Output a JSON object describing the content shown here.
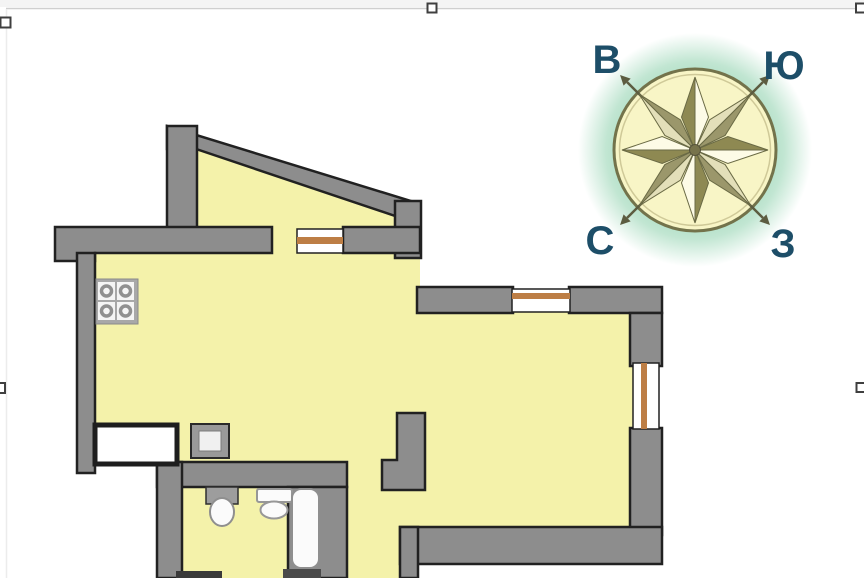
{
  "canvas": {
    "w": 864,
    "h": 578,
    "bg": "#ffffff"
  },
  "editor_selection": {
    "top_strip": {
      "x": 0,
      "y": 0,
      "w": 864,
      "h": 7,
      "fill": "#f4f4f4"
    },
    "lines": [
      {
        "name": "selection-border-top",
        "x1": 6,
        "y1": 8.5,
        "x2": 861,
        "y2": 8.5,
        "color": "#cfcfcf",
        "sw": 1.5
      },
      {
        "name": "selection-border-left",
        "x1": 6.5,
        "y1": 9,
        "x2": 6.5,
        "y2": 578,
        "color": "#ececec",
        "sw": 1.5
      }
    ],
    "handle_style": {
      "fill": "#ffffff",
      "stroke": "#3f3f3f",
      "sw": 2
    },
    "handles": [
      {
        "name": "handle-top-left",
        "x": 0.5,
        "y": 17.5,
        "w": 10,
        "h": 10
      },
      {
        "name": "handle-top-center",
        "x": 427.5,
        "y": 3.5,
        "w": 9,
        "h": 9
      },
      {
        "name": "handle-top-right",
        "x": 856,
        "y": 3.5,
        "w": 9,
        "h": 9
      },
      {
        "name": "handle-middle-left",
        "x": -5,
        "y": 383,
        "w": 10,
        "h": 10
      },
      {
        "name": "handle-middle-right",
        "x": 856.5,
        "y": 383,
        "w": 9,
        "h": 9
      }
    ]
  },
  "floor_plan": {
    "colors": {
      "floor": "#f4f2aa",
      "wall": "#8d8d8d",
      "outline": "#212121",
      "window_frame": "#bd7e45",
      "fixture_white": "#fbfbfb",
      "fixture_gray": "#9d9d9d"
    },
    "shapes": [
      {
        "k": "poly",
        "n": "floor-balcony",
        "pts": [
          197,
          134,
          414,
          206,
          414,
          232,
          197,
          232
        ],
        "f": "floor"
      },
      {
        "k": "rect",
        "n": "floor-balcony-door-opening",
        "x": 271,
        "y": 222,
        "w": 28,
        "h": 34,
        "f": "floor"
      },
      {
        "k": "rect",
        "n": "floor-main-room",
        "x": 88,
        "y": 234,
        "w": 567,
        "h": 312,
        "f": "floor"
      },
      {
        "k": "rect",
        "n": "floor-hallway-bathroom",
        "x": 180,
        "y": 478,
        "w": 240,
        "h": 100,
        "f": "floor"
      },
      {
        "k": "rect",
        "n": "outside-top-right",
        "x": 420,
        "y": 226,
        "w": 246,
        "h": 63,
        "f": "#ffffff"
      },
      {
        "k": "rect",
        "n": "outside-bottom-left",
        "x": 76,
        "y": 466,
        "w": 81,
        "h": 112,
        "f": "#ffffff"
      },
      {
        "k": "rect",
        "n": "outside-bottom-middle",
        "x": 418,
        "y": 563,
        "w": 248,
        "h": 15,
        "f": "#ffffff"
      },
      {
        "k": "poly",
        "n": "wall-balcony-slope",
        "pts": [
          167,
          126,
          414,
          202,
          410,
          221,
          196,
          149,
          167,
          149
        ],
        "f": "wall",
        "s": "outline",
        "sw": 2.5
      },
      {
        "k": "rect",
        "n": "wall-balcony-left",
        "x": 167,
        "y": 126,
        "w": 30,
        "h": 106,
        "f": "wall",
        "s": "outline",
        "sw": 2.5
      },
      {
        "k": "rect",
        "n": "wall-balcony-right",
        "x": 395,
        "y": 201,
        "w": 26,
        "h": 57,
        "f": "wall",
        "s": "outline",
        "sw": 2.5
      },
      {
        "k": "poly",
        "n": "wall-kitchen-top",
        "pts": [
          55,
          227,
          272,
          227,
          272,
          253,
          95,
          253,
          95,
          261,
          55,
          261
        ],
        "f": "wall",
        "s": "outline",
        "sw": 2.5
      },
      {
        "k": "rect",
        "n": "wall-balcony-window-right",
        "x": 343,
        "y": 227,
        "w": 77,
        "h": 26,
        "f": "wall",
        "s": "outline",
        "sw": 2.5
      },
      {
        "k": "rect",
        "n": "wall-outer-left",
        "x": 77,
        "y": 253,
        "w": 18,
        "h": 220,
        "f": "wall",
        "s": "outline",
        "sw": 2.5
      },
      {
        "k": "rect",
        "n": "wall-north-left",
        "x": 417,
        "y": 287,
        "w": 96,
        "h": 26,
        "f": "wall",
        "s": "outline",
        "sw": 2.5
      },
      {
        "k": "rect",
        "n": "wall-north-right",
        "x": 569,
        "y": 287,
        "w": 93,
        "h": 26,
        "f": "wall",
        "s": "outline",
        "sw": 2.5
      },
      {
        "k": "rect",
        "n": "wall-right-upper",
        "x": 630,
        "y": 313,
        "w": 32,
        "h": 53,
        "f": "wall",
        "s": "outline",
        "sw": 2.5
      },
      {
        "k": "rect",
        "n": "wall-right-lower",
        "x": 630,
        "y": 428,
        "w": 32,
        "h": 107,
        "f": "wall",
        "s": "outline",
        "sw": 2.5
      },
      {
        "k": "rect",
        "n": "wall-bottom",
        "x": 400,
        "y": 527,
        "w": 262,
        "h": 37,
        "f": "wall",
        "s": "outline",
        "sw": 2.5
      },
      {
        "k": "rect",
        "n": "wall-entry-left",
        "x": 400,
        "y": 527,
        "w": 18,
        "h": 51,
        "f": "wall",
        "s": "outline",
        "sw": 2.5
      },
      {
        "k": "rect",
        "n": "wall-bathroom-top",
        "x": 157,
        "y": 462,
        "w": 190,
        "h": 25,
        "f": "wall",
        "s": "outline",
        "sw": 2.5
      },
      {
        "k": "rect",
        "n": "wall-bathroom-left",
        "x": 157,
        "y": 462,
        "w": 25,
        "h": 116,
        "f": "wall",
        "s": "outline",
        "sw": 2.5
      },
      {
        "k": "rect",
        "n": "wall-bathroom-right",
        "x": 288,
        "y": 487,
        "w": 59,
        "h": 91,
        "f": "wall",
        "s": "outline",
        "sw": 2.5
      },
      {
        "k": "poly",
        "n": "wall-hall-stub",
        "pts": [
          397,
          413,
          425,
          413,
          425,
          490,
          382,
          490,
          382,
          460,
          397,
          460
        ],
        "f": "wall",
        "s": "outline",
        "sw": 2.5
      },
      {
        "k": "rect",
        "n": "wall-bathroom-bottom-stub",
        "x": 176,
        "y": 571,
        "w": 46,
        "h": 7,
        "f": "#3a3a3a"
      },
      {
        "k": "rect",
        "n": "window-balcony",
        "x": 297,
        "y": 229,
        "w": 46,
        "h": 24,
        "f": "#ffffff",
        "s": "outline",
        "sw": 1.5
      },
      {
        "k": "rect",
        "n": "window-balcony-frame",
        "x": 297,
        "y": 237,
        "w": 46,
        "h": 7,
        "f": "window_frame"
      },
      {
        "k": "rect",
        "n": "window-north",
        "x": 512,
        "y": 289,
        "w": 58,
        "h": 23,
        "f": "#ffffff",
        "s": "outline",
        "sw": 1.5
      },
      {
        "k": "rect",
        "n": "window-north-frame",
        "x": 512,
        "y": 293,
        "w": 58,
        "h": 6,
        "f": "window_frame"
      },
      {
        "k": "rect",
        "n": "window-east",
        "x": 633,
        "y": 363,
        "w": 26,
        "h": 66,
        "f": "#ffffff",
        "s": "outline",
        "sw": 1.5
      },
      {
        "k": "rect",
        "n": "window-east-frame",
        "x": 641,
        "y": 363,
        "w": 6,
        "h": 66,
        "f": "window_frame"
      },
      {
        "k": "rect",
        "n": "entry-niche",
        "x": 95,
        "y": 425,
        "w": 82,
        "h": 39,
        "f": "#ffffff",
        "s": "#1e1e1e",
        "sw": 5
      },
      {
        "k": "rect",
        "n": "vent-shaft",
        "x": 191,
        "y": 424,
        "w": 38,
        "h": 34,
        "f": "#999999",
        "s": "#2a2a2a",
        "sw": 2
      },
      {
        "k": "rect",
        "n": "vent-shaft-inner",
        "x": 199,
        "y": 431,
        "w": 22,
        "h": 20,
        "f": "#f0f0f0",
        "s": "#7c7c7c",
        "sw": 1
      },
      {
        "k": "rect",
        "n": "stove",
        "x": 96,
        "y": 279,
        "w": 42,
        "h": 45,
        "f": "#a8a8a8",
        "s": "#8a8a8a",
        "sw": 1
      },
      {
        "k": "rect",
        "n": "stove-burner-plate",
        "x": 98,
        "y": 282,
        "w": 17,
        "h": 18,
        "f": "#f5f5f5"
      },
      {
        "k": "rect",
        "n": "stove-burner-plate",
        "x": 117,
        "y": 282,
        "w": 17,
        "h": 18,
        "f": "#f5f5f5"
      },
      {
        "k": "rect",
        "n": "stove-burner-plate",
        "x": 98,
        "y": 302,
        "w": 17,
        "h": 18,
        "f": "#f5f5f5"
      },
      {
        "k": "rect",
        "n": "stove-burner-plate",
        "x": 117,
        "y": 302,
        "w": 17,
        "h": 18,
        "f": "#f5f5f5"
      },
      {
        "k": "circle",
        "n": "stove-burner",
        "cx": 106.5,
        "cy": 291,
        "r": 5,
        "f": "none",
        "s": "#909090",
        "sw": 3.5
      },
      {
        "k": "circle",
        "n": "stove-burner",
        "cx": 125.5,
        "cy": 291,
        "r": 5,
        "f": "none",
        "s": "#909090",
        "sw": 3.5
      },
      {
        "k": "circle",
        "n": "stove-burner",
        "cx": 106.5,
        "cy": 311,
        "r": 5,
        "f": "none",
        "s": "#909090",
        "sw": 3.5
      },
      {
        "k": "circle",
        "n": "stove-burner",
        "cx": 125.5,
        "cy": 311,
        "r": 5,
        "f": "none",
        "s": "#909090",
        "sw": 3.5
      },
      {
        "k": "rect",
        "n": "sink-counter",
        "x": 206,
        "y": 487,
        "w": 32,
        "h": 17,
        "f": "fixture_gray",
        "s": "#2f2f2f",
        "sw": 1.5
      },
      {
        "k": "ellipse",
        "n": "sink-basin",
        "cx": 222,
        "cy": 512,
        "rx": 12,
        "ry": 14,
        "f": "fixture_white",
        "s": "#8f8f8f",
        "sw": 2
      },
      {
        "k": "rect",
        "n": "toilet-tank",
        "x": 257,
        "y": 489,
        "w": 35,
        "h": 13,
        "rx": 2,
        "f": "fixture_white",
        "s": "#979797",
        "sw": 2
      },
      {
        "k": "ellipse",
        "n": "toilet-bowl",
        "cx": 274,
        "cy": 510,
        "rx": 13.5,
        "ry": 8.5,
        "f": "fixture_white",
        "s": "#979797",
        "sw": 2
      },
      {
        "k": "rect",
        "n": "bathtub",
        "x": 292,
        "y": 489,
        "w": 27,
        "h": 79,
        "rx": 9,
        "f": "fixture_white",
        "s": "#8f8f8f",
        "sw": 2
      },
      {
        "k": "rect",
        "n": "bathtub-bottom-dark",
        "x": 283,
        "y": 569,
        "w": 38,
        "h": 9,
        "f": "#4a4a4a"
      }
    ]
  },
  "compass": {
    "cx": 695,
    "cy": 150,
    "glow_radius": 117,
    "circle": {
      "r": 81,
      "fill": "#f8f5c6",
      "stroke": "#73734b",
      "sw": 3
    },
    "inner_ring": {
      "r": 75.5,
      "stroke": "#cfc998",
      "sw": 1.5
    },
    "glow_color": "#98d5b4",
    "cardinal_arms": {
      "angles": [
        0,
        90,
        180,
        270
      ],
      "len": 73,
      "hw": 13.5,
      "midfrac": 0.45,
      "dark": "#8e8952",
      "light": "#fdfbe6",
      "stroke": "#6a6a45"
    },
    "diagonal_arms": {
      "angles": [
        45,
        135,
        225,
        315
      ],
      "len": 79,
      "hw": 11,
      "midfrac": 0.4,
      "dark": "#9b976b",
      "light": "#e3dfb9",
      "stroke": "#6a6a45"
    },
    "spikes": {
      "angles": [
        45,
        135,
        225,
        315
      ],
      "r0": 55,
      "r1": 96,
      "tip": 106,
      "hw": 5,
      "color": "#5c5c40",
      "sw": 2.5
    },
    "hub": {
      "r": 5.5,
      "fill": "#77734b",
      "stroke": "#55523a",
      "sw": 1
    },
    "label_style": {
      "color": "#1d4e68",
      "size": 40
    },
    "labels": [
      {
        "text": "В",
        "x": 607,
        "y": 60,
        "name": "compass-label-east"
      },
      {
        "text": "Ю",
        "x": 784,
        "y": 66,
        "name": "compass-label-south"
      },
      {
        "text": "С",
        "x": 600,
        "y": 241,
        "name": "compass-label-north"
      },
      {
        "text": "З",
        "x": 783,
        "y": 244,
        "name": "compass-label-west"
      }
    ]
  }
}
